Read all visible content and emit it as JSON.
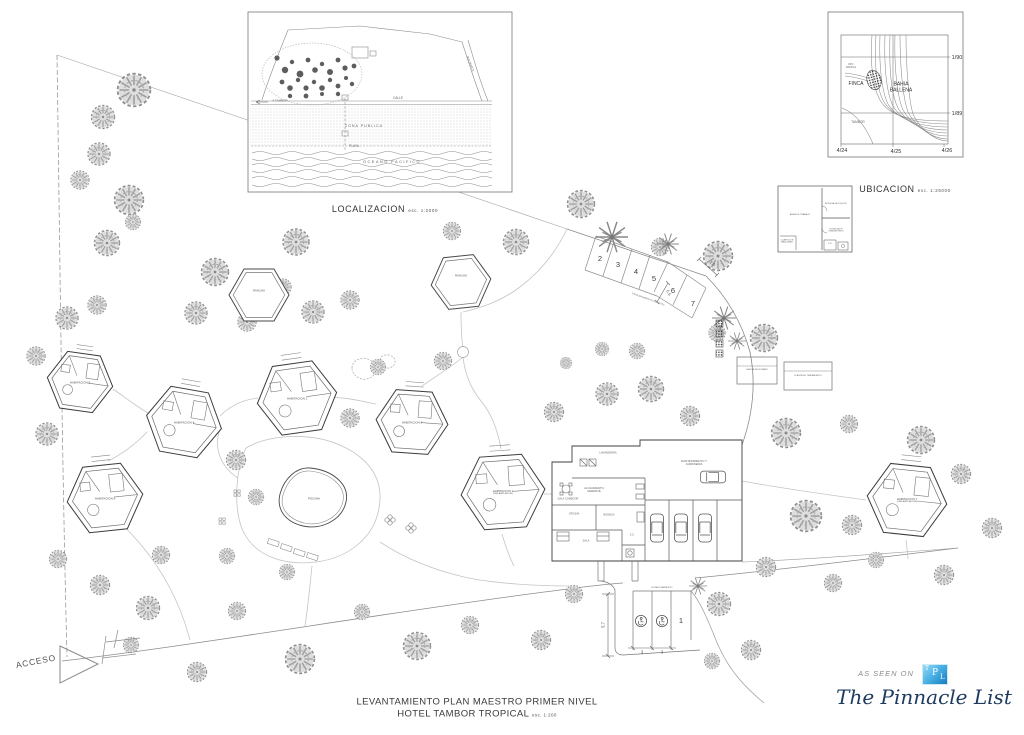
{
  "sheet": {
    "insets": {
      "localizacion": {
        "title": "LOCALIZACION",
        "scale": "esc. 1:2000",
        "calle": "CALLE",
        "a_tambor": "A TAMBOR",
        "zona": "ZONA PUBLICA",
        "playa": "PLAYA",
        "oceano": "OCEANO PACIFICO",
        "rio": "RIO PANICA"
      },
      "ubicacion": {
        "title": "UBICACION",
        "scale": "esc. 1:25000",
        "finca": "FINCA",
        "bahia1": "BAHIA",
        "bahia2": "BALLENA",
        "rio1": "RIO",
        "rio2": "PANICA",
        "tambor": "TAMBOR",
        "row1": "1/90",
        "row2": "1/89",
        "col1": "4/24",
        "col2": "4/25",
        "col3": "4/26"
      },
      "detail": {
        "r1": "AREA DE TRABAJO",
        "r2": "BODEGA DE EQUIPO",
        "r3": "BODEGA DE SUMINISTROS",
        "r4": "CUARTO DE MAQUINAS",
        "r5": "S.S."
      }
    },
    "plan": {
      "acceso": "ACCESO",
      "piscina": "PISCINA",
      "rancho1": "RANCHO",
      "rancho2": "RANCHO",
      "habitaciones": [
        {
          "name": "HABITACION 1",
          "sub": "(VER AMPLIACION)"
        },
        {
          "name": "HABITACION 2",
          "sub": ""
        },
        {
          "name": "HABITACION 3",
          "sub": ""
        },
        {
          "name": "HABITACION 4",
          "sub": ""
        },
        {
          "name": "HABITACION 5",
          "sub": ""
        },
        {
          "name": "HABITACION 6",
          "sub": ""
        },
        {
          "name": "HABITACION 7",
          "sub": "(VER AMPLIACION)"
        }
      ],
      "services": {
        "lavanderia": "LAVANDERIA",
        "mant1": "MANTENIMIENTO Y",
        "mant2": "JARDINERIA",
        "aloj1": "ALOJAMIENTO",
        "aloj2": "GERENTE",
        "sala_comedor": "SALA COMEDOR",
        "oficina": "OFICINA",
        "bodega": "BODEGA",
        "sala": "SALA",
        "ss": "S.S."
      },
      "utilities": {
        "box1": "CASETA DE BOMBEO",
        "box2": "PLANTA DE TRATAMIENTO"
      },
      "parking_top": {
        "stalls": [
          "2",
          "3",
          "4",
          "5",
          "6",
          "7"
        ],
        "dim_a": "2.6",
        "dim_b": "5.5",
        "label": "ESTACIONAMIENTO VISITANTES"
      },
      "parking_bottom": {
        "stall1": "1",
        "dim_h": "5,7",
        "dim_w1": "3",
        "dim_w2": "3",
        "label": "ESTACIONAMIENTO"
      }
    },
    "title": {
      "line1": "LEVANTAMIENTO PLAN MAESTRO PRIMER NIVEL",
      "line2": "HOTEL TAMBOR TROPICAL",
      "scale": "esc. 1:200"
    },
    "branding": {
      "as_seen_on": "AS SEEN ON",
      "logo_t": "T",
      "logo_p": "P",
      "logo_l": "L",
      "name": "The Pinnacle List",
      "logo_color_top": "#9fdef6",
      "logo_color_bottom": "#1379bd",
      "name_color": "#1d3a5f"
    }
  }
}
